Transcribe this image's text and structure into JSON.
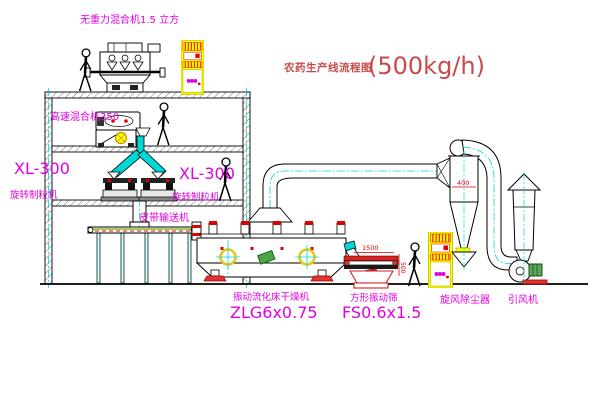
{
  "title": {
    "main": "农药生产线流程图",
    "capacity": "(500kg/h)"
  },
  "labels": {
    "gravity_mixer": "无重力混合机1.5 立方",
    "high_speed_mixer": "高速混合机350",
    "granulator_left_model": "XL-300",
    "granulator_left_name": "旋转制粒机",
    "granulator_right_model": "XL-300",
    "granulator_right_name": "旋转制粒机",
    "belt_conveyor": "皮带输送机",
    "dryer_name": "振动流化床干燥机",
    "dryer_model": "ZLG6x0.75",
    "sieve_name": "方形振动筛",
    "sieve_model": "FS0.6x1.5",
    "cyclone": "旋风除尘器",
    "fan": "引风机"
  },
  "dimensions": {
    "sieve_length": "1500",
    "sieve_outlet": "500",
    "cyclone_body": "400"
  },
  "colors": {
    "title_red": "#c84b4b",
    "label_magenta": "#e100e1",
    "dimension_red": "#e00000",
    "pipe_cyan": "#00d8d8",
    "cabinet_yellow": "#ffff00"
  }
}
